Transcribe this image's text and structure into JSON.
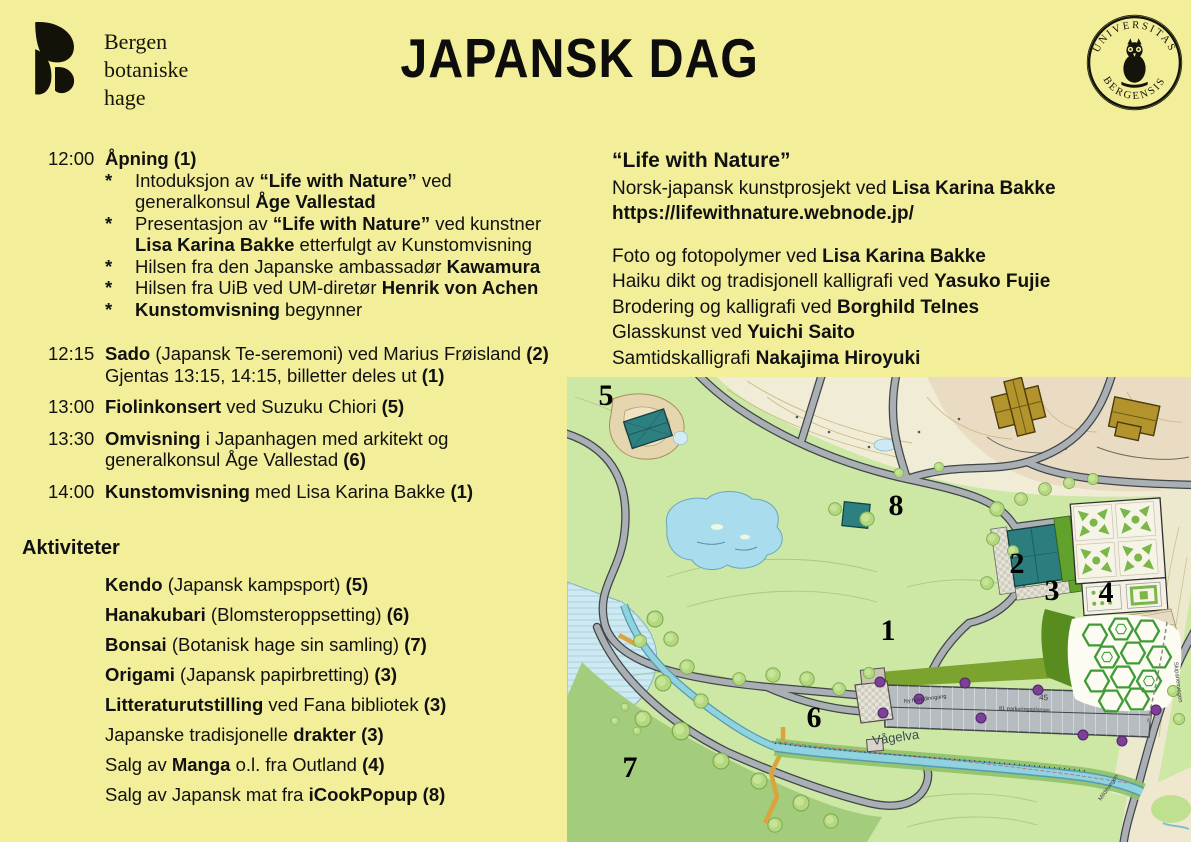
{
  "page": {
    "background": "#f2ee99",
    "text_color": "#111111"
  },
  "header": {
    "logo": {
      "icon": "bergen-botaniske-hage-leaf-logo",
      "name_lines": [
        "Bergen",
        "botaniske",
        "hage"
      ]
    },
    "title": "JAPANSK DAG",
    "seal": {
      "icon": "uib-owl-seal",
      "top_text": "UNIVERSITAS",
      "bottom_text": "BERGENSIS"
    }
  },
  "schedule": {
    "rows": [
      {
        "time": "12:00",
        "lines": [
          [
            {
              "t": "Åpning (1)",
              "b": true
            }
          ]
        ],
        "bullets": [
          {
            "lines": [
              [
                {
                  "t": "Intoduksjon av ",
                  "b": false
                },
                {
                  "t": "“Life with Nature”",
                  "b": true
                },
                {
                  "t": " ved",
                  "b": false
                }
              ],
              [
                {
                  "t": "generalkonsul ",
                  "b": false
                },
                {
                  "t": "Åge Vallestad",
                  "b": true
                }
              ]
            ]
          },
          {
            "lines": [
              [
                {
                  "t": "Presentasjon av ",
                  "b": false
                },
                {
                  "t": "“Life with Nature”",
                  "b": true
                },
                {
                  "t": " ved kunstner",
                  "b": false
                }
              ],
              [
                {
                  "t": "Lisa Karina Bakke",
                  "b": true
                },
                {
                  "t": " etterfulgt av Kunstomvisning",
                  "b": false
                }
              ]
            ]
          },
          {
            "lines": [
              [
                {
                  "t": "Hilsen fra den Japanske ambassadør ",
                  "b": false
                },
                {
                  "t": "Kawamura",
                  "b": true
                }
              ]
            ]
          },
          {
            "lines": [
              [
                {
                  "t": "Hilsen fra UiB ved UM-diretør ",
                  "b": false
                },
                {
                  "t": "Henrik von Achen",
                  "b": true
                }
              ]
            ]
          },
          {
            "lines": [
              [
                {
                  "t": "Kunstomvisning",
                  "b": true
                },
                {
                  "t": " begynner",
                  "b": false
                }
              ]
            ]
          }
        ]
      },
      {
        "time": "12:15",
        "lines": [
          [
            {
              "t": "Sado",
              "b": true
            },
            {
              "t": " (Japansk Te-seremoni) ved Marius Frøisland ",
              "b": false
            },
            {
              "t": "(2)",
              "b": true
            }
          ],
          [
            {
              "t": "Gjentas 13:15, 14:15, billetter deles ut ",
              "b": false
            },
            {
              "t": "(1)",
              "b": true
            }
          ]
        ],
        "bullets": []
      },
      {
        "time": "13:00",
        "lines": [
          [
            {
              "t": "Fiolinkonsert",
              "b": true
            },
            {
              "t": " ved Suzuku Chiori ",
              "b": false
            },
            {
              "t": "(5)",
              "b": true
            }
          ]
        ],
        "bullets": []
      },
      {
        "time": "13:30",
        "lines": [
          [
            {
              "t": "Omvisning",
              "b": true
            },
            {
              "t": " i Japanhagen med arkitekt og",
              "b": false
            }
          ],
          [
            {
              "t": "generalkonsul Åge Vallestad ",
              "b": false
            },
            {
              "t": "(6)",
              "b": true
            }
          ]
        ],
        "bullets": []
      },
      {
        "time": "14:00",
        "lines": [
          [
            {
              "t": "Kunstomvisning",
              "b": true
            },
            {
              "t": " med Lisa Karina Bakke ",
              "b": false
            },
            {
              "t": "(1)",
              "b": true
            }
          ]
        ],
        "bullets": []
      }
    ]
  },
  "activities": {
    "heading": "Aktiviteter",
    "items": [
      [
        {
          "t": "Kendo",
          "b": true
        },
        {
          "t": " (Japansk kampsport) ",
          "b": false
        },
        {
          "t": "(5)",
          "b": true
        }
      ],
      [
        {
          "t": "Hanakubari",
          "b": true
        },
        {
          "t": " (Blomsteroppsetting) ",
          "b": false
        },
        {
          "t": "(6)",
          "b": true
        }
      ],
      [
        {
          "t": "Bonsai",
          "b": true
        },
        {
          "t": " (Botanisk hage sin samling) ",
          "b": false
        },
        {
          "t": "(7)",
          "b": true
        }
      ],
      [
        {
          "t": "Origami",
          "b": true
        },
        {
          "t": " (Japansk papirbretting) ",
          "b": false
        },
        {
          "t": "(3)",
          "b": true
        }
      ],
      [
        {
          "t": "Litteraturutstilling",
          "b": true
        },
        {
          "t": " ved Fana bibliotek ",
          "b": false
        },
        {
          "t": "(3)",
          "b": true
        }
      ],
      [
        {
          "t": "Japanske tradisjonelle ",
          "b": false
        },
        {
          "t": "drakter (3)",
          "b": true
        }
      ],
      [
        {
          "t": "Salg av ",
          "b": false
        },
        {
          "t": "Manga",
          "b": true
        },
        {
          "t": " o.l. fra Outland ",
          "b": false
        },
        {
          "t": "(4)",
          "b": true
        }
      ],
      [
        {
          "t": "Salg av Japansk mat fra ",
          "b": false
        },
        {
          "t": "iCookPopup (8)",
          "b": true
        }
      ]
    ]
  },
  "project": {
    "heading": "“Life with Nature”",
    "intro_lines": [
      [
        {
          "t": "Norsk-japansk kunstprosjekt ved ",
          "b": false
        },
        {
          "t": "Lisa Karina Bakke",
          "b": true
        }
      ],
      [
        {
          "t": "https://lifewithnature.webnode.jp/",
          "b": true
        }
      ]
    ],
    "artist_lines": [
      [
        {
          "t": "Foto og fotopolymer ved ",
          "b": false
        },
        {
          "t": "Lisa Karina Bakke",
          "b": true
        }
      ],
      [
        {
          "t": "Haiku dikt og tradisjonell kalligrafi ved ",
          "b": false
        },
        {
          "t": "Yasuko Fujie",
          "b": true
        }
      ],
      [
        {
          "t": "Brodering og kalligrafi ved ",
          "b": false
        },
        {
          "t": "Borghild Telnes",
          "b": true
        }
      ],
      [
        {
          "t": "Glasskunst ved ",
          "b": false
        },
        {
          "t": "Yuichi Saito",
          "b": true
        }
      ],
      [
        {
          "t": "Samtidskalligrafi ",
          "b": false
        },
        {
          "t": "Nakajima Hiroyuki",
          "b": true
        }
      ]
    ]
  },
  "map": {
    "markers": [
      {
        "n": "1",
        "x": 321,
        "y": 263
      },
      {
        "n": "2",
        "x": 450,
        "y": 196
      },
      {
        "n": "3",
        "x": 485,
        "y": 223
      },
      {
        "n": "4",
        "x": 539,
        "y": 225
      },
      {
        "n": "5",
        "x": 39,
        "y": 28
      },
      {
        "n": "6",
        "x": 247,
        "y": 350
      },
      {
        "n": "7",
        "x": 63,
        "y": 400
      },
      {
        "n": "8",
        "x": 329,
        "y": 138
      }
    ],
    "labels": [
      {
        "text": "Vågelva",
        "x": 306,
        "y": 368,
        "size": 13,
        "rot": -8,
        "color": "#3d4a52"
      },
      {
        "text": "45",
        "x": 472,
        "y": 323,
        "size": 8,
        "rot": 2,
        "color": "#333333"
      },
      {
        "text": "81 parkeringsplasser",
        "x": 432,
        "y": 333,
        "size": 5.5,
        "rot": 2,
        "color": "#333333"
      },
      {
        "text": "Ny hovedinngang",
        "x": 337,
        "y": 326,
        "size": 5.5,
        "rot": -7,
        "color": "#333333"
      },
      {
        "text": "Skipanesvegen",
        "x": 607,
        "y": 285,
        "size": 6,
        "rot": 83,
        "color": "#444444"
      },
      {
        "text": "Mildevegen",
        "x": 534,
        "y": 424,
        "size": 6,
        "rot": -55,
        "color": "#444444"
      }
    ]
  }
}
